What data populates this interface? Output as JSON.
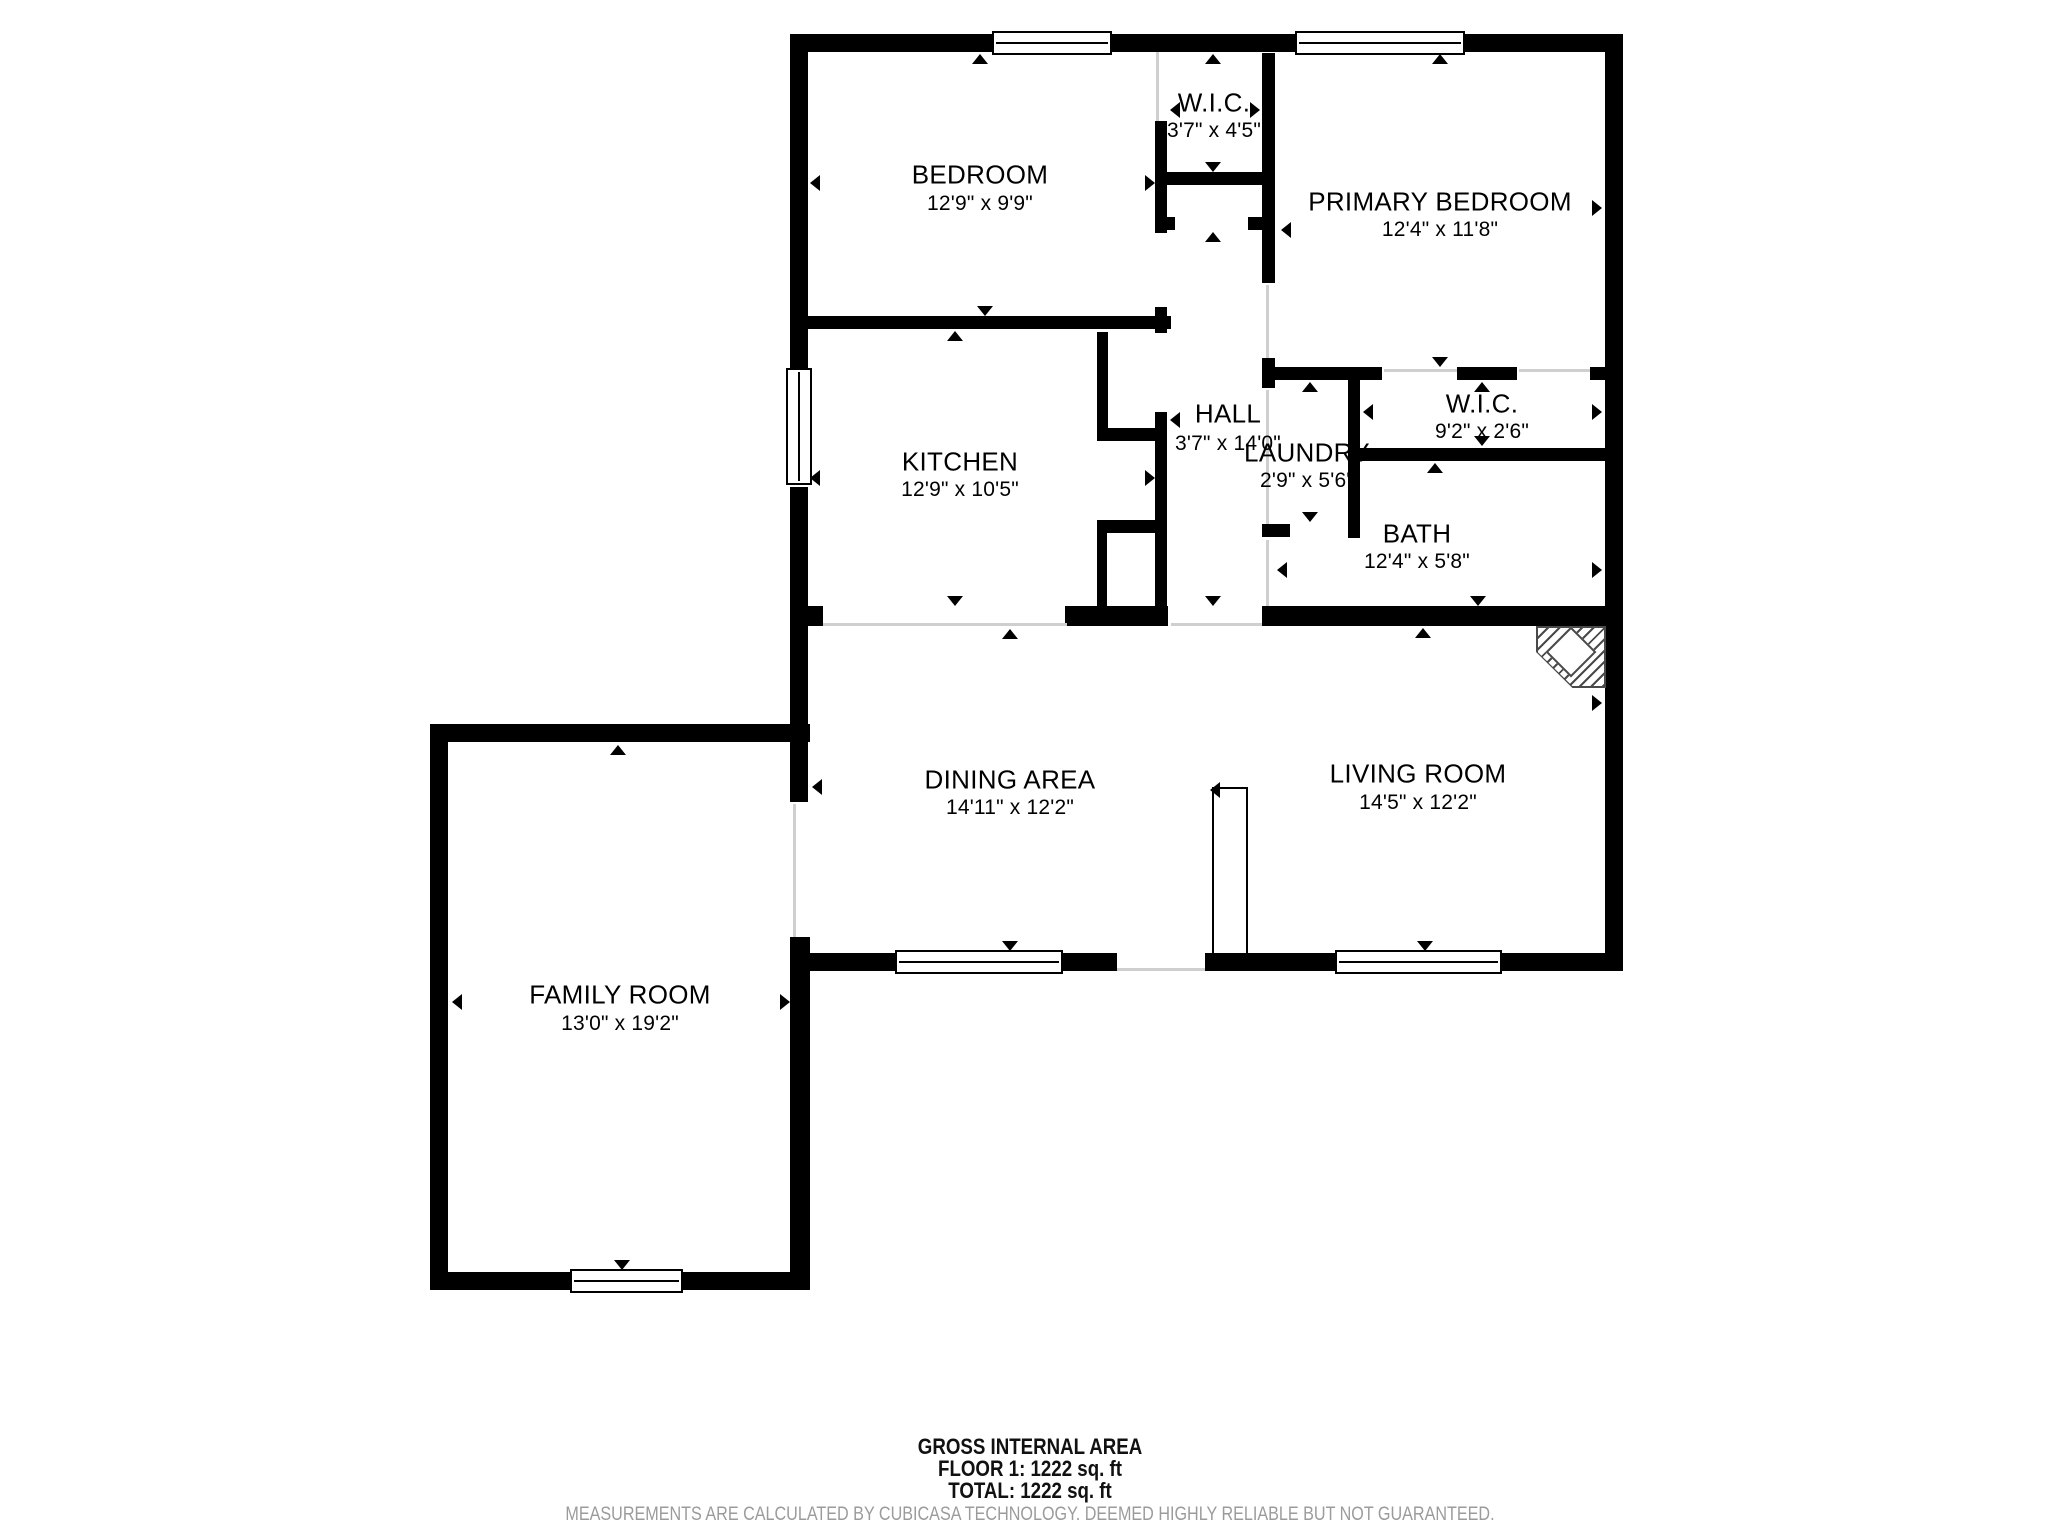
{
  "footer": {
    "title": "GROSS INTERNAL AREA",
    "floor_line": "FLOOR 1: 1222 sq. ft",
    "total_line": "TOTAL: 1222 sq. ft",
    "disclaimer": "MEASUREMENTS ARE CALCULATED BY CUBICASA TECHNOLOGY. DEEMED HIGHLY RELIABLE BUT NOT GUARANTEED."
  },
  "colors": {
    "wall": "#000000",
    "label": "#000000",
    "disclaimer": "#9b9b9b",
    "background": "#ffffff",
    "threshold": "#cfcfcf"
  },
  "plan": {
    "rooms": [
      {
        "id": "bedroom",
        "name": "BEDROOM",
        "dims": "12'9\" x 9'9\"",
        "cx": 980,
        "name_y": 175,
        "dims_y": 204
      },
      {
        "id": "wic-top",
        "name": "W.I.C.",
        "dims": "3'7\" x 4'5\"",
        "cx": 1214,
        "name_y": 103,
        "dims_y": 131
      },
      {
        "id": "primary-bedroom",
        "name": "PRIMARY BEDROOM",
        "dims": "12'4\" x 11'8\"",
        "cx": 1440,
        "name_y": 202,
        "dims_y": 230
      },
      {
        "id": "kitchen",
        "name": "KITCHEN",
        "dims": "12'9\" x 10'5\"",
        "cx": 960,
        "name_y": 462,
        "dims_y": 490
      },
      {
        "id": "hall",
        "name": "HALL",
        "dims": "3'7\" x 14'0\"",
        "cx": 1228,
        "name_y": 414,
        "dims_y": 444
      },
      {
        "id": "laundry",
        "name": "LAUNDRY",
        "dims": "2'9\" x 5'6\"",
        "cx": 1307,
        "name_y": 453,
        "dims_y": 481
      },
      {
        "id": "wic-right",
        "name": "W.I.C.",
        "dims": "9'2\" x 2'6\"",
        "cx": 1482,
        "name_y": 404,
        "dims_y": 432
      },
      {
        "id": "bath",
        "name": "BATH",
        "dims": "12'4\" x 5'8\"",
        "cx": 1417,
        "name_y": 534,
        "dims_y": 562
      },
      {
        "id": "dining-area",
        "name": "DINING AREA",
        "dims": "14'11\" x 12'2\"",
        "cx": 1010,
        "name_y": 780,
        "dims_y": 808
      },
      {
        "id": "living-room",
        "name": "LIVING ROOM",
        "dims": "14'5\" x 12'2\"",
        "cx": 1418,
        "name_y": 774,
        "dims_y": 803
      },
      {
        "id": "family-room",
        "name": "FAMILY ROOM",
        "dims": "13'0\" x 19'2\"",
        "cx": 620,
        "name_y": 995,
        "dims_y": 1024
      }
    ],
    "walls": [
      {
        "id": "family-top",
        "x": 430,
        "y": 724,
        "w": 380,
        "h": 18
      },
      {
        "id": "family-left",
        "x": 430,
        "y": 724,
        "w": 18,
        "h": 566
      },
      {
        "id": "family-bottom",
        "x": 430,
        "y": 1272,
        "w": 380,
        "h": 18
      },
      {
        "id": "main-top",
        "x": 790,
        "y": 34,
        "w": 833,
        "h": 18
      },
      {
        "id": "main-left-upper",
        "x": 790,
        "y": 34,
        "w": 18,
        "h": 336
      },
      {
        "id": "main-left-mid",
        "x": 790,
        "y": 487,
        "w": 18,
        "h": 315
      },
      {
        "id": "shared-left-lower",
        "x": 790,
        "y": 937,
        "w": 20,
        "h": 353
      },
      {
        "id": "main-right",
        "x": 1605,
        "y": 34,
        "w": 18,
        "h": 937
      },
      {
        "id": "main-bottom-a",
        "x": 790,
        "y": 953,
        "w": 105,
        "h": 18
      },
      {
        "id": "main-bottom-b",
        "x": 1063,
        "y": 953,
        "w": 54,
        "h": 18
      },
      {
        "id": "main-bottom-c",
        "x": 1205,
        "y": 953,
        "w": 130,
        "h": 18
      },
      {
        "id": "main-bottom-d",
        "x": 1502,
        "y": 953,
        "w": 121,
        "h": 18
      },
      {
        "id": "bedroom-kitchen",
        "x": 808,
        "y": 316,
        "w": 363,
        "h": 13
      },
      {
        "id": "wic-top-left",
        "x": 1155,
        "y": 121,
        "w": 12,
        "h": 112
      },
      {
        "id": "wic-top-bottom",
        "x": 1165,
        "y": 172,
        "w": 110,
        "h": 13
      },
      {
        "id": "vestibule-stub-left",
        "x": 1155,
        "y": 217,
        "w": 20,
        "h": 13
      },
      {
        "id": "vestibule-stub-right",
        "x": 1248,
        "y": 217,
        "w": 27,
        "h": 13
      },
      {
        "id": "hall-left-a",
        "x": 1155,
        "y": 307,
        "w": 12,
        "h": 26
      },
      {
        "id": "hall-left-b",
        "x": 1155,
        "y": 412,
        "w": 12,
        "h": 214
      },
      {
        "id": "hall-closet-left",
        "x": 1097,
        "y": 332,
        "w": 11,
        "h": 96
      },
      {
        "id": "hall-closet-bottom",
        "x": 1097,
        "y": 428,
        "w": 60,
        "h": 13
      },
      {
        "id": "chase-top",
        "x": 1097,
        "y": 520,
        "w": 70,
        "h": 13
      },
      {
        "id": "chase-left",
        "x": 1097,
        "y": 533,
        "w": 10,
        "h": 77
      },
      {
        "id": "kitchen-bottom",
        "x": 1065,
        "y": 606,
        "w": 103,
        "h": 20
      },
      {
        "id": "kitchen-bottom-stub",
        "x": 790,
        "y": 606,
        "w": 33,
        "h": 20
      },
      {
        "id": "hall-right-a",
        "x": 1262,
        "y": 53,
        "w": 13,
        "h": 230
      },
      {
        "id": "hall-right-b",
        "x": 1262,
        "y": 358,
        "w": 13,
        "h": 30
      },
      {
        "id": "laundry-bottom-stub",
        "x": 1262,
        "y": 524,
        "w": 28,
        "h": 13
      },
      {
        "id": "utility-top-a",
        "x": 1262,
        "y": 367,
        "w": 120,
        "h": 13
      },
      {
        "id": "utility-top-b",
        "x": 1457,
        "y": 367,
        "w": 60,
        "h": 13
      },
      {
        "id": "utility-top-c",
        "x": 1590,
        "y": 367,
        "w": 33,
        "h": 13
      },
      {
        "id": "laundry-right",
        "x": 1348,
        "y": 367,
        "w": 12,
        "h": 171
      },
      {
        "id": "bath-top",
        "x": 1348,
        "y": 448,
        "w": 275,
        "h": 13
      },
      {
        "id": "bath-bottom",
        "x": 1262,
        "y": 606,
        "w": 361,
        "h": 20
      }
    ],
    "windows": [
      {
        "id": "bedroom-window",
        "x": 992,
        "y": 31,
        "w": 120,
        "h": 24,
        "orient": "h"
      },
      {
        "id": "primary-window",
        "x": 1295,
        "y": 31,
        "w": 170,
        "h": 24,
        "orient": "h"
      },
      {
        "id": "kitchen-window",
        "x": 786,
        "y": 368,
        "w": 26,
        "h": 117,
        "orient": "v"
      },
      {
        "id": "dining-window",
        "x": 895,
        "y": 950,
        "w": 168,
        "h": 24,
        "orient": "h"
      },
      {
        "id": "living-window",
        "x": 1335,
        "y": 950,
        "w": 167,
        "h": 24,
        "orient": "h"
      },
      {
        "id": "family-window",
        "x": 570,
        "y": 1269,
        "w": 113,
        "h": 24,
        "orient": "h"
      }
    ],
    "door_leaf": {
      "x": 1212,
      "y": 787,
      "w": 36,
      "h": 168
    },
    "fireplace": {
      "x": 1536,
      "y": 626,
      "w": 70,
      "h": 62
    },
    "thresholds": [
      {
        "x": 1156,
        "y": 52,
        "w": 3,
        "h": 69
      },
      {
        "x": 1266,
        "y": 285,
        "w": 3,
        "h": 73
      },
      {
        "x": 1266,
        "y": 390,
        "w": 3,
        "h": 134
      },
      {
        "x": 1266,
        "y": 540,
        "w": 3,
        "h": 66
      },
      {
        "x": 1384,
        "y": 369,
        "w": 73,
        "h": 3
      },
      {
        "x": 1519,
        "y": 369,
        "w": 71,
        "h": 3
      },
      {
        "x": 823,
        "y": 623,
        "w": 244,
        "h": 3
      },
      {
        "x": 1171,
        "y": 623,
        "w": 91,
        "h": 3
      },
      {
        "x": 793,
        "y": 804,
        "w": 3,
        "h": 133
      },
      {
        "x": 1117,
        "y": 968,
        "w": 88,
        "h": 3
      }
    ],
    "ticks": [
      {
        "dir": "u",
        "x": 980,
        "y": 54
      },
      {
        "dir": "d",
        "x": 985,
        "y": 316
      },
      {
        "dir": "l",
        "x": 810,
        "y": 183
      },
      {
        "dir": "r",
        "x": 1155,
        "y": 183
      },
      {
        "dir": "u",
        "x": 1213,
        "y": 54
      },
      {
        "dir": "d",
        "x": 1213,
        "y": 172
      },
      {
        "dir": "l",
        "x": 1170,
        "y": 110
      },
      {
        "dir": "r",
        "x": 1260,
        "y": 110
      },
      {
        "dir": "u",
        "x": 1440,
        "y": 54
      },
      {
        "dir": "d",
        "x": 1440,
        "y": 367
      },
      {
        "dir": "l",
        "x": 1281,
        "y": 230
      },
      {
        "dir": "r",
        "x": 1602,
        "y": 208
      },
      {
        "dir": "u",
        "x": 955,
        "y": 331
      },
      {
        "dir": "d",
        "x": 955,
        "y": 606
      },
      {
        "dir": "l",
        "x": 810,
        "y": 478
      },
      {
        "dir": "r",
        "x": 1155,
        "y": 478
      },
      {
        "dir": "u",
        "x": 1213,
        "y": 232
      },
      {
        "dir": "d",
        "x": 1213,
        "y": 606
      },
      {
        "dir": "l",
        "x": 1170,
        "y": 420
      },
      {
        "dir": "u",
        "x": 1310,
        "y": 382
      },
      {
        "dir": "d",
        "x": 1310,
        "y": 522
      },
      {
        "dir": "u",
        "x": 1482,
        "y": 382
      },
      {
        "dir": "d",
        "x": 1482,
        "y": 446
      },
      {
        "dir": "l",
        "x": 1363,
        "y": 412
      },
      {
        "dir": "r",
        "x": 1602,
        "y": 412
      },
      {
        "dir": "u",
        "x": 1435,
        "y": 463
      },
      {
        "dir": "d",
        "x": 1478,
        "y": 606
      },
      {
        "dir": "l",
        "x": 1277,
        "y": 570
      },
      {
        "dir": "r",
        "x": 1602,
        "y": 570
      },
      {
        "dir": "u",
        "x": 1010,
        "y": 629
      },
      {
        "dir": "d",
        "x": 1010,
        "y": 951
      },
      {
        "dir": "l",
        "x": 812,
        "y": 787
      },
      {
        "dir": "u",
        "x": 1423,
        "y": 628
      },
      {
        "dir": "d",
        "x": 1425,
        "y": 951
      },
      {
        "dir": "l",
        "x": 1210,
        "y": 790
      },
      {
        "dir": "r",
        "x": 1602,
        "y": 703
      },
      {
        "dir": "u",
        "x": 618,
        "y": 745
      },
      {
        "dir": "d",
        "x": 622,
        "y": 1270
      },
      {
        "dir": "l",
        "x": 452,
        "y": 1002
      },
      {
        "dir": "r",
        "x": 790,
        "y": 1002
      }
    ]
  }
}
